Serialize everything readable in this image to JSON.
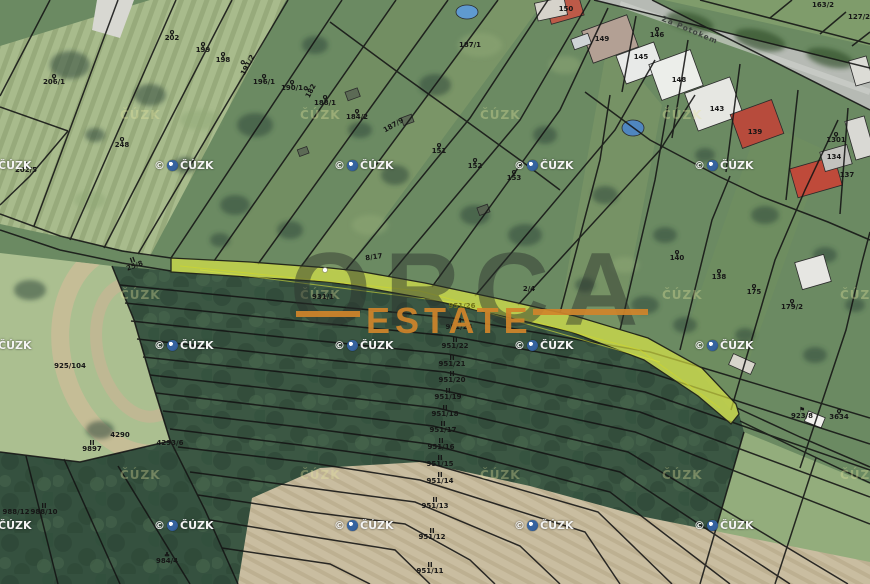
{
  "map": {
    "street_name": "Za Potokem",
    "watermarks": {
      "brand_line1": "ORCA",
      "brand_line2": "ESTATE",
      "copyright_prefix": "©",
      "copyright_label": "ČÚZK",
      "faint_label": "ČÚZK",
      "logo_positions": [
        [
          -28,
          159
        ],
        [
          154,
          159
        ],
        [
          334,
          159
        ],
        [
          514,
          159
        ],
        [
          694,
          159
        ],
        [
          -28,
          339
        ],
        [
          154,
          339
        ],
        [
          334,
          339
        ],
        [
          514,
          339
        ],
        [
          694,
          339
        ],
        [
          -28,
          519
        ],
        [
          154,
          519
        ],
        [
          334,
          519
        ],
        [
          514,
          519
        ],
        [
          694,
          519
        ]
      ],
      "faint_positions": [
        [
          120,
          108
        ],
        [
          300,
          108
        ],
        [
          480,
          108
        ],
        [
          662,
          108
        ],
        [
          120,
          288
        ],
        [
          300,
          288
        ],
        [
          662,
          288
        ],
        [
          840,
          288
        ],
        [
          120,
          468
        ],
        [
          300,
          468
        ],
        [
          480,
          468
        ],
        [
          662,
          468
        ],
        [
          840,
          468
        ]
      ]
    },
    "highlight_color": "#e9f243",
    "symbols": {
      "orchard": "ϙ",
      "meadow": "II",
      "tree": "♣",
      "flag": "⚑"
    },
    "symbol_names": {
      "orchard": "orchard-symbol-icon",
      "meadow": "meadow-symbol-icon",
      "tree": "tree-symbol-icon",
      "flag": "flag-symbol-icon"
    },
    "parcel_labels": [
      {
        "t": "206/1",
        "x": 54,
        "y": 80,
        "s": "orchard"
      },
      {
        "t": "202/5",
        "x": 26,
        "y": 168,
        "s": "orchard"
      },
      {
        "t": "248",
        "x": 122,
        "y": 143,
        "s": "orchard"
      },
      {
        "t": "202",
        "x": 172,
        "y": 36,
        "s": "orchard"
      },
      {
        "t": "199",
        "x": 203,
        "y": 48,
        "s": "orchard"
      },
      {
        "t": "198",
        "x": 223,
        "y": 58,
        "s": "orchard"
      },
      {
        "t": "191/2",
        "x": 246,
        "y": 64,
        "s": "orchard",
        "r": -62
      },
      {
        "t": "196/1",
        "x": 264,
        "y": 80,
        "s": "orchard"
      },
      {
        "t": "190/1",
        "x": 292,
        "y": 86,
        "s": "orchard"
      },
      {
        "t": "182",
        "x": 309,
        "y": 90,
        "s": "orchard",
        "r": -62
      },
      {
        "t": "188/1",
        "x": 325,
        "y": 101,
        "s": "orchard"
      },
      {
        "t": "184/2",
        "x": 357,
        "y": 115,
        "s": "orchard"
      },
      {
        "t": "187/9",
        "x": 394,
        "y": 126,
        "r": -30
      },
      {
        "t": "187/1",
        "x": 470,
        "y": 46
      },
      {
        "t": "151",
        "x": 439,
        "y": 149,
        "s": "orchard"
      },
      {
        "t": "152",
        "x": 475,
        "y": 164,
        "s": "orchard"
      },
      {
        "t": "153",
        "x": 514,
        "y": 176,
        "s": "orchard"
      },
      {
        "t": "150",
        "x": 566,
        "y": 10
      },
      {
        "t": "146",
        "x": 657,
        "y": 33,
        "s": "orchard"
      },
      {
        "t": "149",
        "x": 602,
        "y": 40
      },
      {
        "t": "145",
        "x": 641,
        "y": 58
      },
      {
        "t": "148",
        "x": 679,
        "y": 81
      },
      {
        "t": "143",
        "x": 717,
        "y": 110
      },
      {
        "t": "139",
        "x": 755,
        "y": 133
      },
      {
        "t": "1301",
        "x": 836,
        "y": 138,
        "s": "orchard"
      },
      {
        "t": "134",
        "x": 834,
        "y": 158
      },
      {
        "t": "137",
        "x": 847,
        "y": 176
      },
      {
        "t": "163/2",
        "x": 823,
        "y": 6
      },
      {
        "t": "127/2",
        "x": 859,
        "y": 18
      },
      {
        "t": "140",
        "x": 677,
        "y": 256,
        "s": "orchard"
      },
      {
        "t": "138",
        "x": 719,
        "y": 275,
        "s": "orchard"
      },
      {
        "t": "175",
        "x": 754,
        "y": 290,
        "s": "orchard"
      },
      {
        "t": "179/2",
        "x": 792,
        "y": 305,
        "s": "orchard"
      },
      {
        "t": "25/8",
        "x": 134,
        "y": 264,
        "s": "meadow",
        "r": -20
      },
      {
        "t": "8/17",
        "x": 374,
        "y": 258,
        "r": -8
      },
      {
        "t": "2/4",
        "x": 529,
        "y": 290
      },
      {
        "t": "925/104",
        "x": 70,
        "y": 367
      },
      {
        "t": "931/1",
        "x": 323,
        "y": 298
      },
      {
        "t": "951/26",
        "x": 462,
        "y": 307,
        "c": "olive"
      },
      {
        "t": "951/24",
        "x": 459,
        "y": 325,
        "s": "meadow"
      },
      {
        "t": "951/22",
        "x": 455,
        "y": 344,
        "s": "meadow"
      },
      {
        "t": "951/21",
        "x": 452,
        "y": 362,
        "s": "meadow"
      },
      {
        "t": "951/20",
        "x": 452,
        "y": 378,
        "s": "meadow"
      },
      {
        "t": "951/19",
        "x": 448,
        "y": 395,
        "s": "meadow"
      },
      {
        "t": "951/18",
        "x": 445,
        "y": 412,
        "s": "meadow"
      },
      {
        "t": "951/17",
        "x": 443,
        "y": 428,
        "s": "meadow"
      },
      {
        "t": "951/16",
        "x": 441,
        "y": 445,
        "s": "meadow"
      },
      {
        "t": "951/15",
        "x": 440,
        "y": 462,
        "s": "meadow"
      },
      {
        "t": "951/14",
        "x": 440,
        "y": 479,
        "s": "meadow"
      },
      {
        "t": "951/13",
        "x": 435,
        "y": 504,
        "s": "meadow"
      },
      {
        "t": "951/12",
        "x": 432,
        "y": 535,
        "s": "meadow"
      },
      {
        "t": "951/11",
        "x": 430,
        "y": 569,
        "s": "meadow"
      },
      {
        "t": "9897",
        "x": 92,
        "y": 447,
        "s": "meadow"
      },
      {
        "t": "4290",
        "x": 120,
        "y": 436
      },
      {
        "t": "4293/6",
        "x": 170,
        "y": 444
      },
      {
        "t": "988/12",
        "x": 16,
        "y": 513
      },
      {
        "t": "988/10",
        "x": 44,
        "y": 510,
        "s": "meadow"
      },
      {
        "t": "984/4",
        "x": 167,
        "y": 559,
        "s": "tree"
      },
      {
        "t": "923/8",
        "x": 802,
        "y": 414,
        "s": "flag"
      },
      {
        "t": "3634",
        "x": 839,
        "y": 415,
        "s": "orchard"
      }
    ]
  }
}
